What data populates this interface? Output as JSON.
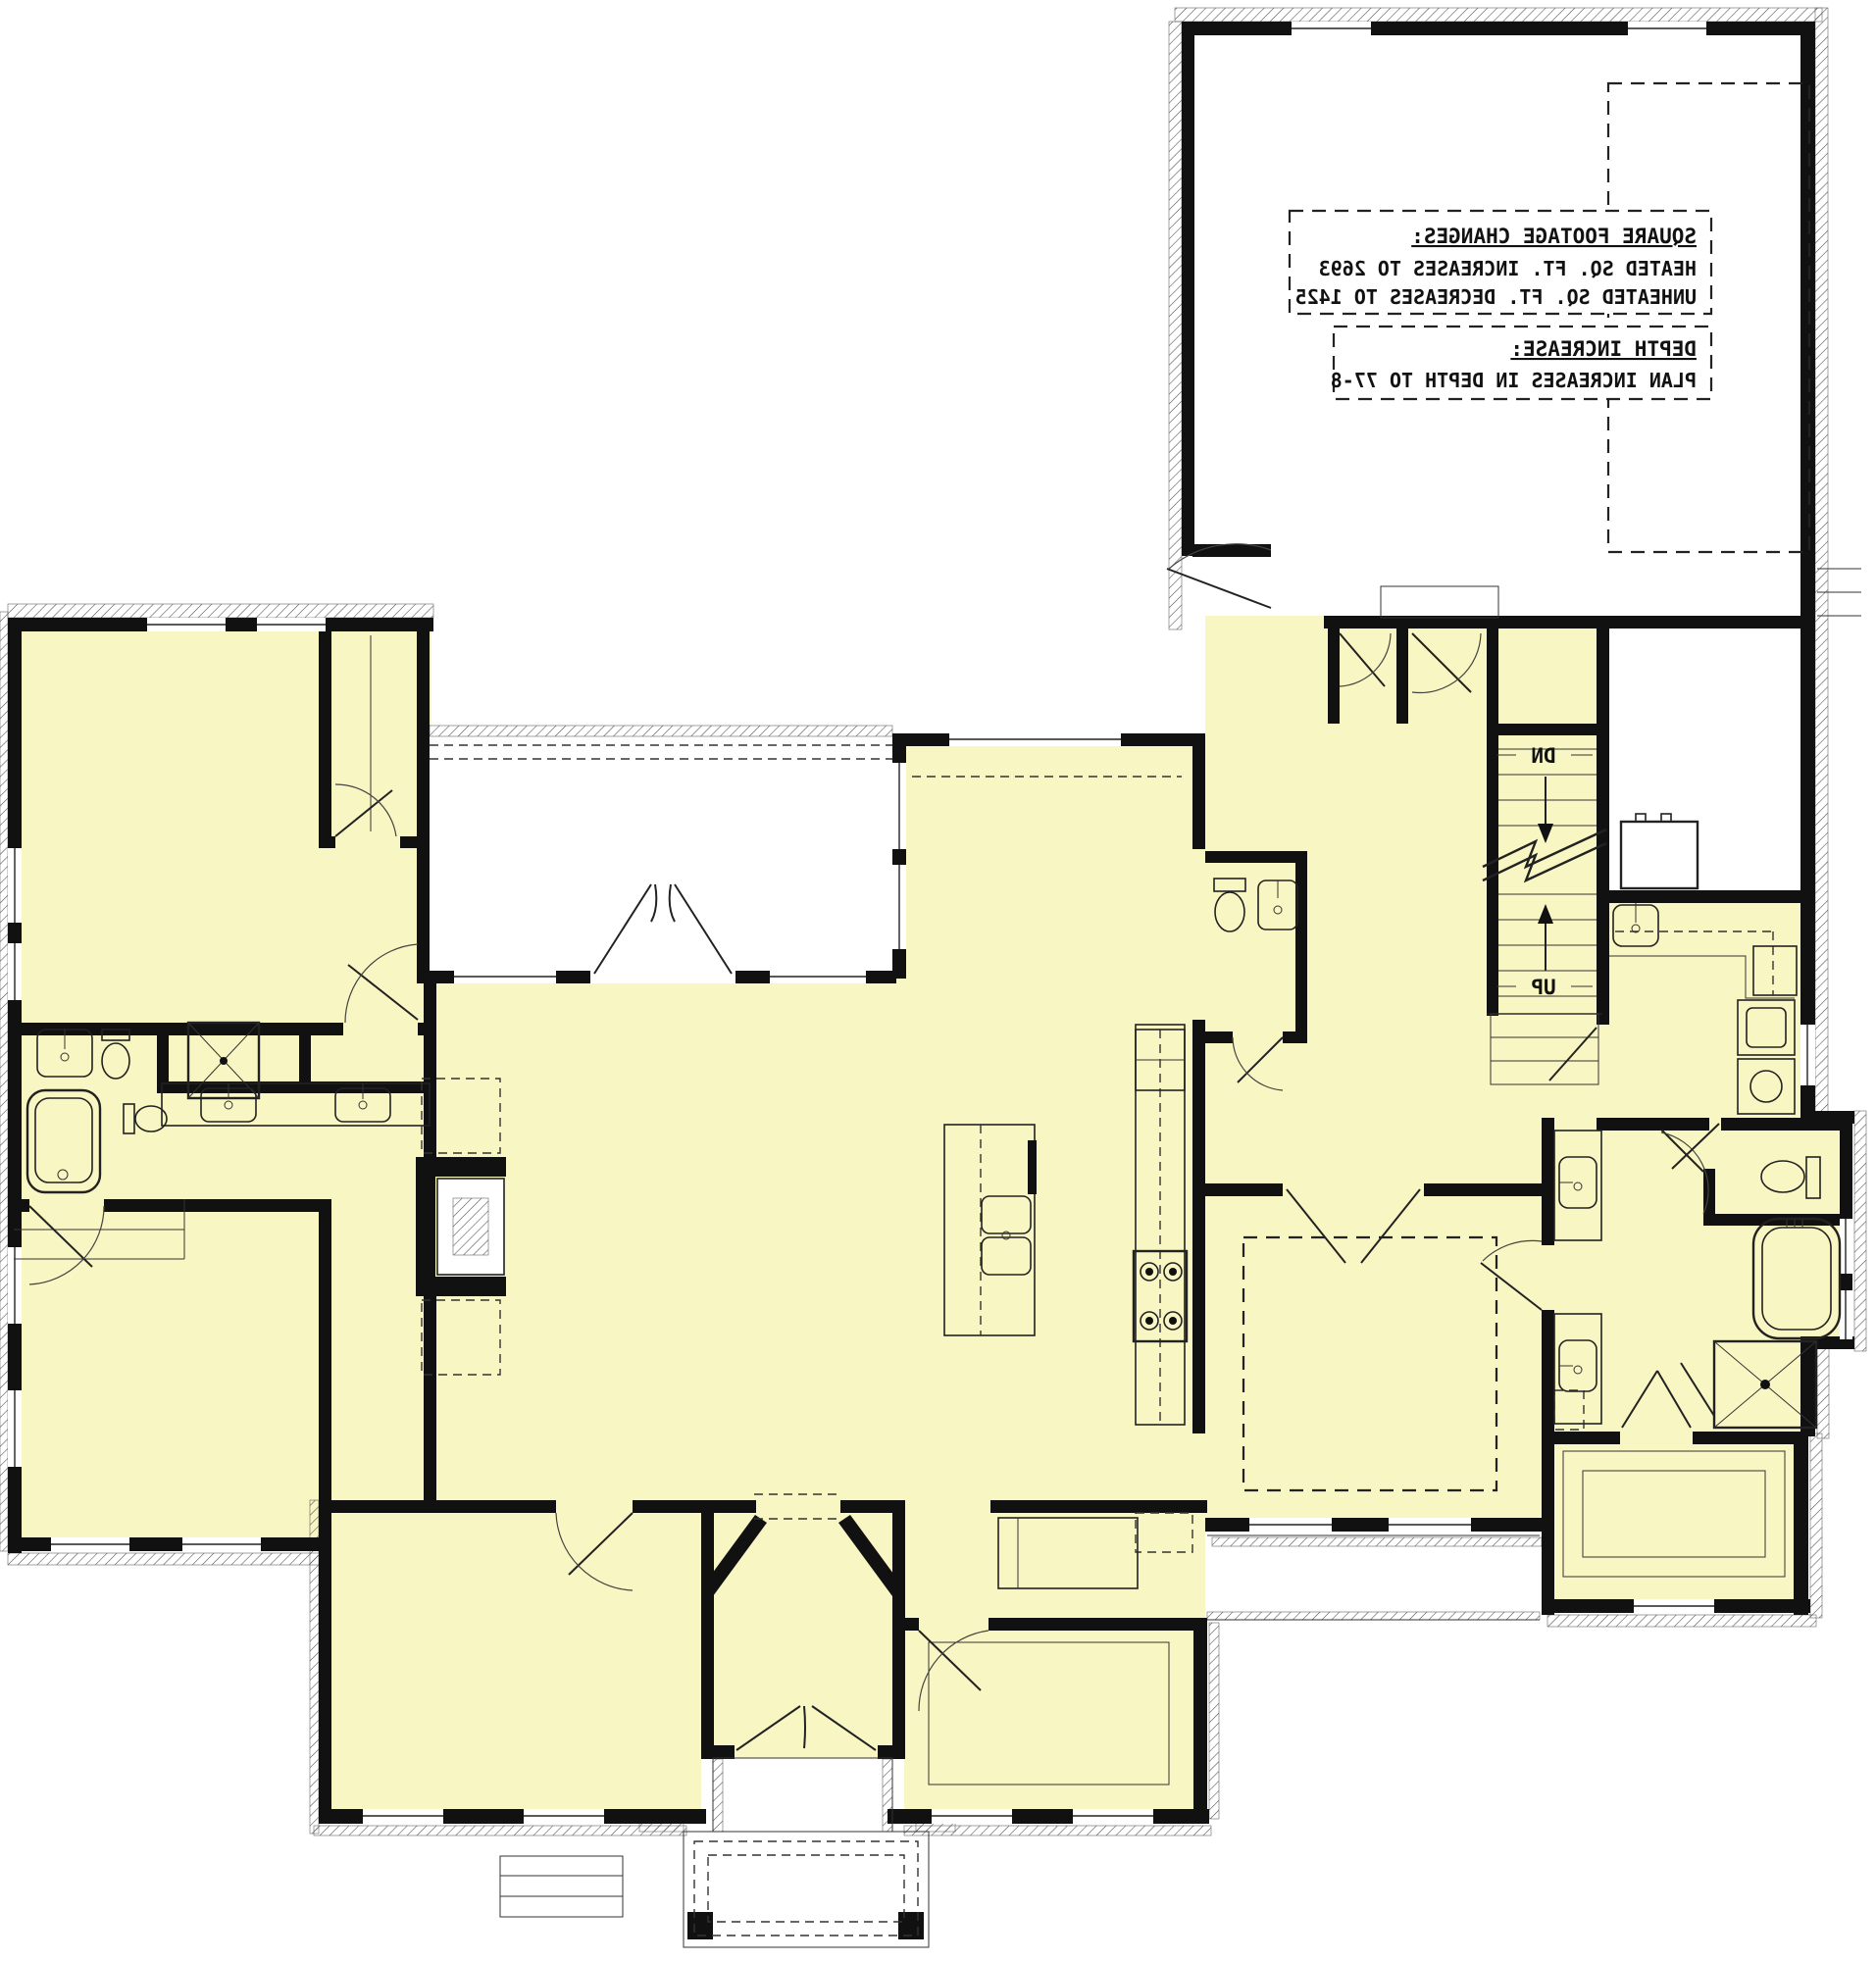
{
  "drawing": {
    "type": "architectural-first-floor-plan",
    "orientation": "mirror-reversed-print",
    "colors": {
      "room_fill": "#f8f6c2",
      "wall": "#111111",
      "background": "#ffffff",
      "hatch": "#4a4a4a"
    },
    "annotation_boxes": {
      "square_footage": {
        "heading": "SQUARE FOOTAGE CHANGES:",
        "line1": "HEATED SQ. FT. INCREASES TO 2693",
        "line2": "UNHEATED SQ. FT. DECREASES TO 1425"
      },
      "depth_increase": {
        "heading": "DEPTH INCREASE:",
        "line1": "PLAN INCREASES IN DEPTH TO 77-8"
      }
    },
    "stairs": {
      "down_label": "DN",
      "up_label": "UP"
    }
  }
}
